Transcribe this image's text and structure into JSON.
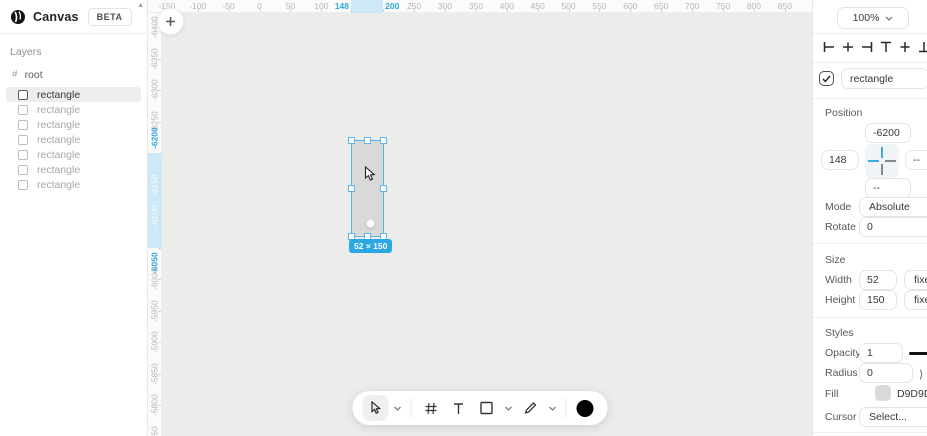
{
  "app": {
    "name": "Canvas",
    "badge": "BETA"
  },
  "sidebar": {
    "layers_title": "Layers",
    "root_label": "root",
    "layers": [
      {
        "label": "rectangle",
        "selected": true
      },
      {
        "label": "rectangle",
        "selected": false
      },
      {
        "label": "rectangle",
        "selected": false
      },
      {
        "label": "rectangle",
        "selected": false
      },
      {
        "label": "rectangle",
        "selected": false
      },
      {
        "label": "rectangle",
        "selected": false
      },
      {
        "label": "rectangle",
        "selected": false
      }
    ]
  },
  "canvas": {
    "add_button": "+",
    "h_ruler": {
      "highlight_from": 148,
      "highlight_to": 200,
      "ticks": [
        {
          "v": -150,
          "label": "-150",
          "kind": "n"
        },
        {
          "v": -100,
          "label": "-100",
          "kind": "n"
        },
        {
          "v": -50,
          "label": "-50",
          "kind": "n"
        },
        {
          "v": 0,
          "label": "0",
          "kind": "n"
        },
        {
          "v": 50,
          "label": "50",
          "kind": "n"
        },
        {
          "v": 100,
          "label": "100",
          "kind": "n"
        },
        {
          "v": 148,
          "label": "148",
          "kind": "b",
          "align": "before"
        },
        {
          "v": 200,
          "label": "200",
          "kind": "b",
          "align": "after"
        },
        {
          "v": 250,
          "label": "250",
          "kind": "n"
        },
        {
          "v": 300,
          "label": "300",
          "kind": "n"
        },
        {
          "v": 350,
          "label": "350",
          "kind": "n"
        },
        {
          "v": 400,
          "label": "400",
          "kind": "n"
        },
        {
          "v": 450,
          "label": "450",
          "kind": "n"
        },
        {
          "v": 500,
          "label": "500",
          "kind": "n"
        },
        {
          "v": 550,
          "label": "550",
          "kind": "n"
        },
        {
          "v": 600,
          "label": "600",
          "kind": "n"
        },
        {
          "v": 650,
          "label": "650",
          "kind": "n"
        },
        {
          "v": 700,
          "label": "700",
          "kind": "n"
        },
        {
          "v": 750,
          "label": "750",
          "kind": "n"
        },
        {
          "v": 800,
          "label": "800",
          "kind": "n"
        },
        {
          "v": 850,
          "label": "850",
          "kind": "n"
        }
      ]
    },
    "v_ruler": {
      "highlight_from": -6200,
      "highlight_to": -6050,
      "ticks": [
        {
          "v": -6400,
          "label": "-6400",
          "kind": "n"
        },
        {
          "v": -6350,
          "label": "-6350",
          "kind": "n"
        },
        {
          "v": -6300,
          "label": "-6300",
          "kind": "n"
        },
        {
          "v": -6250,
          "label": "-6250",
          "kind": "n"
        },
        {
          "v": -6200,
          "label": "-6200",
          "kind": "b",
          "align": "before"
        },
        {
          "v": -6150,
          "label": "-6150",
          "kind": "w"
        },
        {
          "v": -6100,
          "label": "-6100",
          "kind": "w"
        },
        {
          "v": -6050,
          "label": "-6050",
          "kind": "b",
          "align": "after"
        },
        {
          "v": -6000,
          "label": "-6000",
          "kind": "n"
        },
        {
          "v": -5950,
          "label": "-5950",
          "kind": "n"
        },
        {
          "v": -5900,
          "label": "-5900",
          "kind": "n"
        },
        {
          "v": -5850,
          "label": "-5850",
          "kind": "n"
        },
        {
          "v": -5800,
          "label": "-5800",
          "kind": "n"
        },
        {
          "v": -5750,
          "label": "-5750",
          "kind": "n"
        }
      ]
    },
    "selection_badge": "52 × 150"
  },
  "toolbar": {
    "tools": [
      "cursor",
      "chevron-down",
      "divider",
      "grid",
      "text",
      "rectangle",
      "chevron-down",
      "pen",
      "chevron-down",
      "divider",
      "color-swatch"
    ]
  },
  "panel": {
    "zoom_value": "100%",
    "align_icons": [
      "align-left",
      "align-center-horizontal",
      "align-right",
      "align-top",
      "align-center-vertical",
      "align-bottom",
      "distribute-horizontal"
    ],
    "name_field": "rectangle",
    "position": {
      "title": "Position",
      "y": "-6200",
      "x": "148",
      "right": "--",
      "bottom": "--",
      "mode_label": "Mode",
      "mode_value": "Absolute",
      "rotate_label": "Rotate",
      "rotate_value": "0"
    },
    "size": {
      "title": "Size",
      "width_label": "Width",
      "width_value": "52",
      "width_mode": "fixed",
      "height_label": "Height",
      "height_value": "150",
      "height_mode": "fixed"
    },
    "styles": {
      "title": "Styles",
      "opacity_label": "Opacity",
      "opacity_value": "1",
      "radius_label": "Radius",
      "radius_value": "0",
      "fill_label": "Fill",
      "fill_value": "D9D9D9",
      "fill_color": "#D9D9D9",
      "cursor_label": "Cursor",
      "cursor_value": "Select..."
    }
  },
  "colors": {
    "accent_blue": "#29A8E1",
    "selection_stroke": "#5AB6E6",
    "ruler_band": "#CDE9F8",
    "rect_fill": "#D9D9D9"
  }
}
